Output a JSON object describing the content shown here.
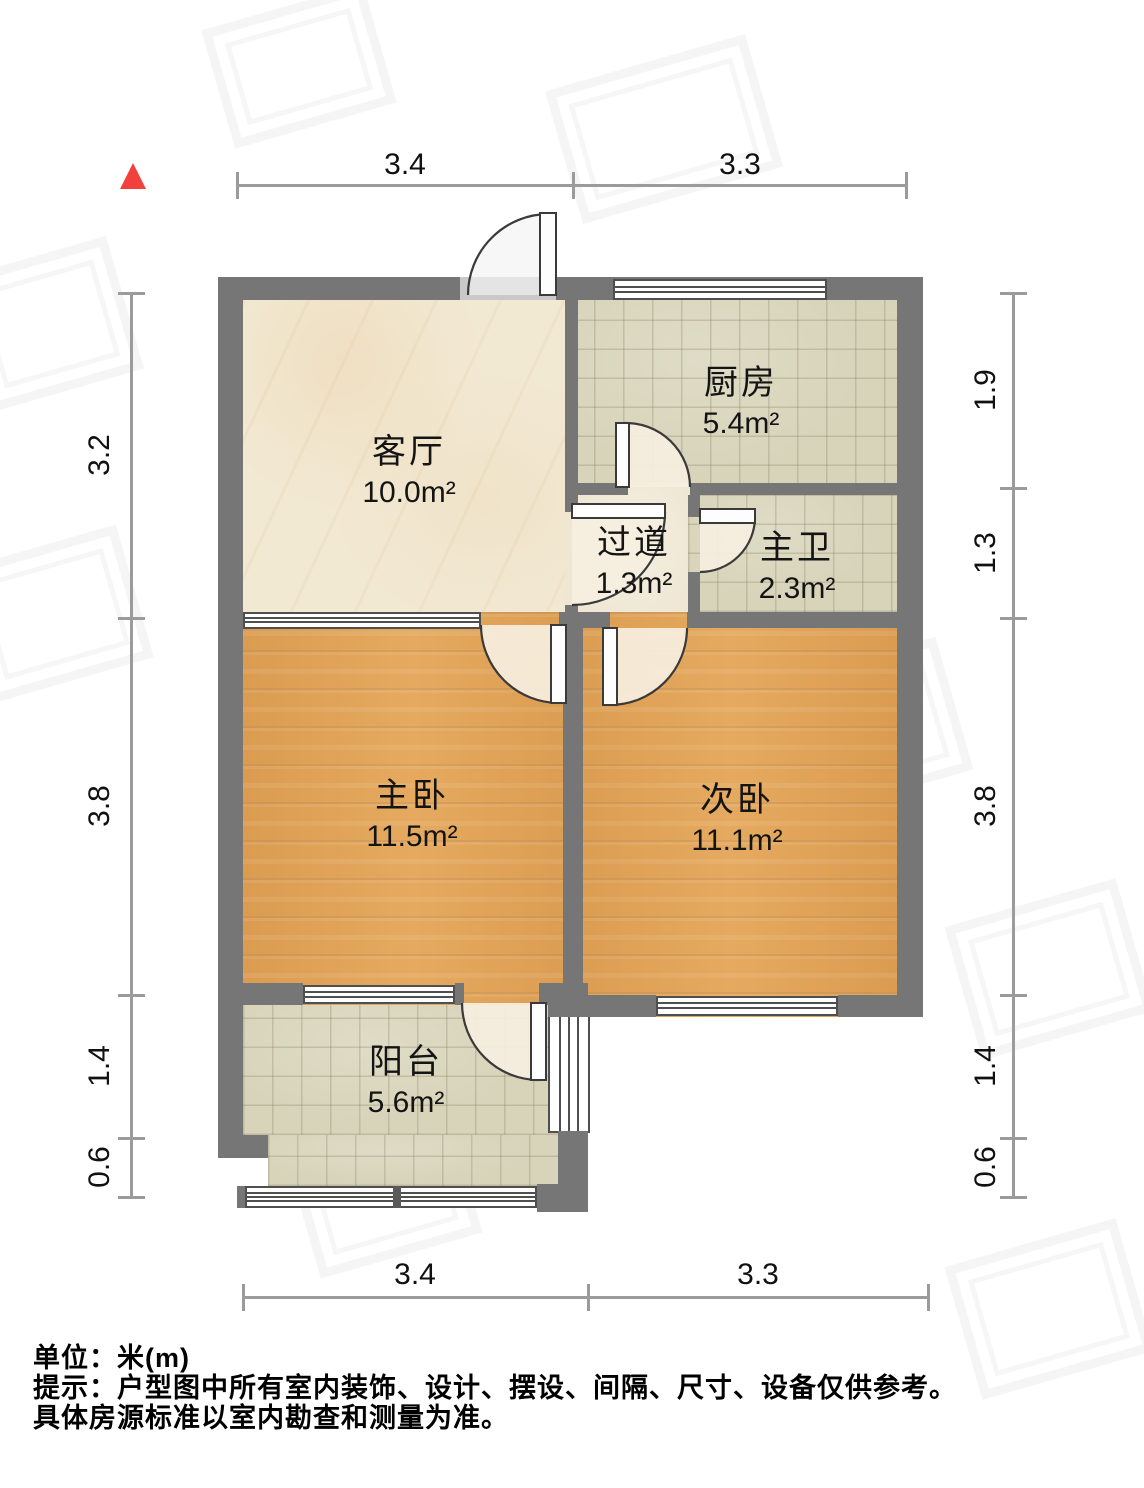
{
  "plan": {
    "unit_note": "单位：米(m)",
    "tip_line1": "提示：户型图中所有室内装饰、设计、摆设、间隔、尺寸、设备仅供参考。",
    "tip_line2": "具体房源标准以室内勘查和测量为准。",
    "rooms": [
      {
        "id": "living",
        "name": "客厅",
        "area": "10.0m²"
      },
      {
        "id": "kitchen",
        "name": "厨房",
        "area": "5.4m²"
      },
      {
        "id": "hallway",
        "name": "过道",
        "area": "1.3m²"
      },
      {
        "id": "bath",
        "name": "主卫",
        "area": "2.3m²"
      },
      {
        "id": "master",
        "name": "主卧",
        "area": "11.5m²"
      },
      {
        "id": "second",
        "name": "次卧",
        "area": "11.1m²"
      },
      {
        "id": "balcony",
        "name": "阳台",
        "area": "5.6m²"
      }
    ],
    "dimensions": {
      "top": [
        "3.4",
        "3.3"
      ],
      "bottom": [
        "3.4",
        "3.3"
      ],
      "left": [
        "3.2",
        "3.8",
        "1.4",
        "0.6"
      ],
      "right": [
        "1.9",
        "1.3",
        "3.8",
        "1.4",
        "0.6"
      ]
    },
    "colors": {
      "wall": "#767676",
      "wood_floor": "#e2a458",
      "tile_floor": "#d8d4ba",
      "marble_floor": "#f2e9d3",
      "north_indicator": "#f2413d",
      "dimension_line": "#9b9b9b"
    }
  }
}
